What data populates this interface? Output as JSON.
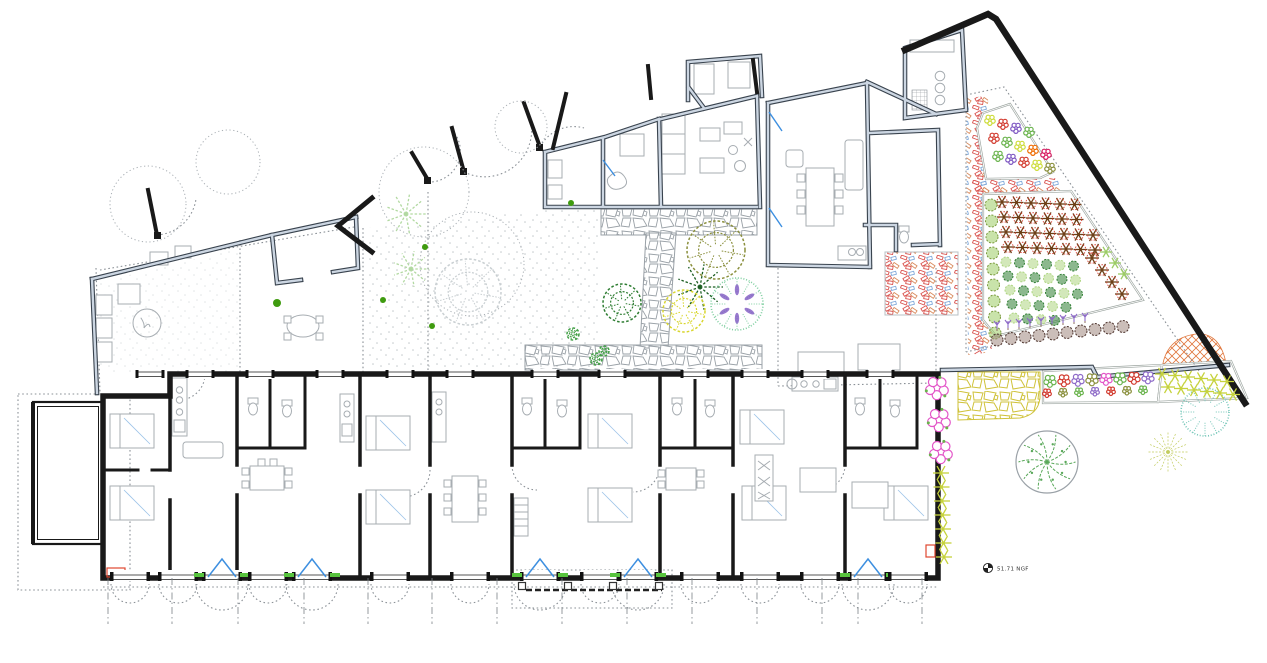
{
  "annotations": {
    "level_marker": "51.71 NGF"
  },
  "palette": {
    "new_wall": "#191919",
    "existing_wall_edge": "#39434e",
    "existing_wall_core": "#ccd6e2",
    "furniture_line": "#a7adb2",
    "stone_joint": "#9aa1a7",
    "yellow_stone": "#cfc23a",
    "rubble_red": "#d9534f",
    "rubble_blue": "#7fa8d9",
    "orange_hatch": "#e0763c",
    "door_blue": "#3d8fe0",
    "threshold_green": "#58c43e",
    "boundary_dot": "#8a9096",
    "pink_flower": "#e356c8",
    "purple_flower": "#8e6bc8",
    "olive_tree": "#8a8f3c",
    "yellow_tree": "#d9d62f",
    "teal_tree": "#74c6b8",
    "dark_green": "#2e7d32",
    "light_green": "#b2d9a1"
  },
  "facade": {
    "bottom_bays": [
      {
        "x": 130,
        "type": "window"
      },
      {
        "x": 178,
        "type": "window"
      },
      {
        "x": 222,
        "type": "door"
      },
      {
        "x": 268,
        "type": "window"
      },
      {
        "x": 312,
        "type": "door"
      },
      {
        "x": 390,
        "type": "window"
      },
      {
        "x": 470,
        "type": "window"
      },
      {
        "x": 540,
        "type": "door"
      },
      {
        "x": 600,
        "type": "window"
      },
      {
        "x": 638,
        "type": "door"
      },
      {
        "x": 700,
        "type": "window"
      },
      {
        "x": 760,
        "type": "window"
      },
      {
        "x": 820,
        "type": "window"
      },
      {
        "x": 868,
        "type": "door"
      },
      {
        "x": 908,
        "type": "window"
      }
    ],
    "top_windows": [
      150,
      200,
      260,
      330,
      400,
      460,
      545,
      612,
      695,
      755,
      815,
      880
    ]
  },
  "grid_axes": [
    108,
    172,
    238,
    304,
    368,
    432,
    497,
    562,
    627,
    692,
    757,
    822,
    858,
    922
  ],
  "pergola": {
    "posts": [
      522,
      568,
      613,
      659
    ],
    "rail": [
      526,
      662
    ],
    "y": 586
  },
  "plants": [
    {
      "name": "tree-canopy",
      "type": "canopy",
      "x": 148,
      "y": 204,
      "r": 38,
      "color": "#a9afb4"
    },
    {
      "name": "tree-canopy",
      "type": "canopy",
      "x": 228,
      "y": 162,
      "r": 32,
      "color": "#a9afb4"
    },
    {
      "name": "tree-canopy",
      "type": "canopy",
      "x": 424,
      "y": 192,
      "r": 45,
      "color": "#a9afb4"
    },
    {
      "name": "tree-canopy",
      "type": "canopy",
      "x": 472,
      "y": 264,
      "r": 52,
      "color": "#a9afb4"
    },
    {
      "name": "tree-canopy",
      "type": "canopy",
      "x": 521,
      "y": 127,
      "r": 26,
      "color": "#a9afb4"
    },
    {
      "name": "palm-tree",
      "type": "palm",
      "x": 406,
      "y": 214,
      "r": 20,
      "color": "#b2d9a1"
    },
    {
      "name": "palm-tree",
      "type": "palm",
      "x": 411,
      "y": 269,
      "r": 18,
      "color": "#b2d9a1"
    },
    {
      "name": "outline-tree",
      "type": "scribble",
      "x": 468,
      "y": 292,
      "r": 33,
      "color": "#c9cfd2"
    },
    {
      "name": "courtyard-tree",
      "type": "scribble",
      "x": 622,
      "y": 303,
      "r": 19,
      "color": "#2e7d32"
    },
    {
      "name": "courtyard-palm",
      "type": "palm",
      "x": 700,
      "y": 287,
      "r": 23,
      "color": "#1b5e20"
    },
    {
      "name": "courtyard-tree",
      "type": "scribble",
      "x": 716,
      "y": 250,
      "r": 29,
      "color": "#8a8f3c"
    },
    {
      "name": "courtyard-tree",
      "type": "scribble",
      "x": 684,
      "y": 311,
      "r": 21,
      "color": "#d9d62f"
    },
    {
      "name": "courtyard-tree",
      "type": "fringe",
      "x": 737,
      "y": 304,
      "r": 26,
      "color": "#7fcfa0",
      "accent": "#7e57c2"
    },
    {
      "name": "shrub",
      "type": "scribble",
      "x": 573,
      "y": 334,
      "r": 6,
      "color": "#43a047"
    },
    {
      "name": "shrub",
      "type": "scribble",
      "x": 596,
      "y": 359,
      "r": 6,
      "color": "#43a047"
    },
    {
      "name": "shrub",
      "type": "scribble",
      "x": 604,
      "y": 351,
      "r": 5,
      "color": "#43a047"
    },
    {
      "name": "small-plant",
      "type": "dot",
      "x": 277,
      "y": 303,
      "r": 4,
      "color": "#3f9b0f"
    },
    {
      "name": "small-plant",
      "type": "dot",
      "x": 383,
      "y": 300,
      "r": 3,
      "color": "#3f9b0f"
    },
    {
      "name": "small-plant",
      "type": "dot",
      "x": 432,
      "y": 326,
      "r": 3,
      "color": "#3f9b0f"
    },
    {
      "name": "small-plant",
      "type": "dot",
      "x": 425,
      "y": 247,
      "r": 3,
      "color": "#3f9b0f"
    },
    {
      "name": "small-plant",
      "type": "dot",
      "x": 571,
      "y": 203,
      "r": 3,
      "color": "#3f9b0f"
    },
    {
      "name": "round-tree",
      "type": "branch",
      "x": 1047,
      "y": 462,
      "r": 31,
      "color": "#5aa85a"
    },
    {
      "name": "radial-tree",
      "type": "radial",
      "x": 1168,
      "y": 452,
      "r": 20,
      "color": "#c2cc5e"
    },
    {
      "name": "teal-tree",
      "type": "fringe",
      "x": 1205,
      "y": 412,
      "r": 24,
      "color": "#74c6b8"
    },
    {
      "name": "pink-shrub",
      "type": "cluster",
      "x": 937,
      "y": 388,
      "r": 13,
      "color": "#e356c8",
      "accent": "#69b34c"
    },
    {
      "name": "pink-shrub",
      "type": "cluster",
      "x": 939,
      "y": 420,
      "r": 13,
      "color": "#e356c8",
      "accent": "#69b34c"
    },
    {
      "name": "pink-shrub",
      "type": "cluster",
      "x": 941,
      "y": 452,
      "r": 13,
      "color": "#e356c8",
      "accent": "#69b34c"
    }
  ],
  "plant_rows": [
    {
      "name": "orchard-row",
      "type": "star",
      "color": "#6d3f17",
      "accent": "#d23b2f",
      "x0": 1002,
      "y0": 202,
      "dx": 14.5,
      "dy": 0.5,
      "n": 6,
      "r": 7
    },
    {
      "name": "orchard-row",
      "type": "star",
      "color": "#6d3f17",
      "accent": "#d23b2f",
      "x0": 1004,
      "y0": 217,
      "dx": 14.5,
      "dy": 0.5,
      "n": 6,
      "r": 7
    },
    {
      "name": "orchard-row",
      "type": "star",
      "color": "#6d3f17",
      "accent": "#d23b2f",
      "x0": 1006,
      "y0": 232,
      "dx": 14.5,
      "dy": 0.5,
      "n": 7,
      "r": 7
    },
    {
      "name": "orchard-row",
      "type": "star",
      "color": "#6d3f17",
      "accent": "#d23b2f",
      "x0": 1008,
      "y0": 247,
      "dx": 14.5,
      "dy": 0.5,
      "n": 7,
      "r": 7
    },
    {
      "name": "hedge-column",
      "type": "shrub",
      "color": "#9ccc65",
      "accent": "#7a9a3d",
      "x0": 991,
      "y0": 205,
      "dx": 0.5,
      "dy": 16,
      "n": 9,
      "r": 6
    },
    {
      "name": "crop-row",
      "colors": [
        "#aed581",
        "#2e7d32"
      ],
      "type": "shrub",
      "x0": 1006,
      "y0": 262,
      "dx": 13.5,
      "dy": 0.8,
      "n": 6,
      "r": 5
    },
    {
      "name": "crop-row",
      "colors": [
        "#2e7d32",
        "#aed581"
      ],
      "type": "shrub",
      "x0": 1008,
      "y0": 276,
      "dx": 13.5,
      "dy": 0.8,
      "n": 6,
      "r": 5
    },
    {
      "name": "crop-row",
      "colors": [
        "#aed581",
        "#2e7d32"
      ],
      "type": "shrub",
      "x0": 1010,
      "y0": 290,
      "dx": 13.5,
      "dy": 0.8,
      "n": 6,
      "r": 5
    },
    {
      "name": "crop-row",
      "colors": [
        "#2e7d32",
        "#aed581"
      ],
      "type": "shrub",
      "x0": 1012,
      "y0": 304,
      "dx": 13.5,
      "dy": 0.8,
      "n": 5,
      "r": 5
    },
    {
      "name": "crop-row",
      "colors": [
        "#aed581",
        "#2e7d32"
      ],
      "type": "shrub",
      "x0": 1014,
      "y0": 318,
      "dx": 13.5,
      "dy": 0.8,
      "n": 4,
      "r": 5
    },
    {
      "name": "orchard-diagonal",
      "type": "star",
      "color": "#6d3f17",
      "accent": "#d23b2f",
      "x0": 1092,
      "y0": 258,
      "dx": 10,
      "dy": 12,
      "n": 4,
      "r": 7
    },
    {
      "name": "orchard-diagonal",
      "type": "star",
      "color": "#9ccc65",
      "x0": 1106,
      "y0": 252,
      "dx": 9,
      "dy": 11,
      "n": 3,
      "r": 6
    },
    {
      "name": "lavender-row",
      "type": "sprig",
      "color": "#8e6bc8",
      "x0": 997,
      "y0": 326,
      "dx": 11,
      "dy": -1,
      "n": 9,
      "r": 5
    },
    {
      "name": "shrub-row",
      "type": "shrub",
      "color": "#a1887f",
      "accent": "#4e342e",
      "x0": 997,
      "y0": 340,
      "dx": 14,
      "dy": -1.5,
      "n": 10,
      "r": 6
    },
    {
      "name": "yellow-plant-column",
      "type": "star",
      "color": "#c6d23c",
      "x0": 941,
      "y0": 473,
      "dx": 0.5,
      "dy": 14,
      "n": 7,
      "r": 8
    },
    {
      "name": "yellow-plant-strip",
      "type": "star",
      "color": "#c6d23c",
      "x0": 1162,
      "y0": 374,
      "dx": 13,
      "dy": 1.5,
      "n": 6,
      "r": 7
    },
    {
      "name": "yellow-plant-strip",
      "type": "star",
      "color": "#c6d23c",
      "x0": 1168,
      "y0": 387,
      "dx": 13,
      "dy": 1.5,
      "n": 6,
      "r": 7
    },
    {
      "name": "flower-strip",
      "colors": [
        "#69b34c",
        "#d23b2f",
        "#8e6bc8",
        "#8a8f3c",
        "#e356c8"
      ],
      "type": "cluster",
      "x0": 1050,
      "y0": 381,
      "dx": 14,
      "dy": -0.5,
      "n": 8,
      "r": 7
    },
    {
      "name": "flower-strip",
      "colors": [
        "#d23b2f",
        "#8a8f3c",
        "#69b34c",
        "#8e6bc8"
      ],
      "type": "cluster",
      "x0": 1047,
      "y0": 393,
      "dx": 16,
      "dy": -0.5,
      "n": 7,
      "r": 5
    },
    {
      "name": "flower-bed-row",
      "colors": [
        "#cddc39",
        "#d23b2f",
        "#7e57c2",
        "#69b34c"
      ],
      "type": "cluster",
      "x0": 990,
      "y0": 120,
      "dx": 13,
      "dy": 4,
      "n": 4,
      "r": 6
    },
    {
      "name": "flower-bed-row",
      "colors": [
        "#d23b2f",
        "#69b34c",
        "#cddc39",
        "#ef6c00",
        "#d81b60"
      ],
      "type": "cluster",
      "x0": 994,
      "y0": 138,
      "dx": 13,
      "dy": 4,
      "n": 5,
      "r": 6
    },
    {
      "name": "flower-bed-row",
      "colors": [
        "#69b34c",
        "#7e57c2",
        "#d23b2f",
        "#cddc39",
        "#8a8f3c"
      ],
      "type": "cluster",
      "x0": 998,
      "y0": 156,
      "dx": 13,
      "dy": 3,
      "n": 5,
      "r": 6
    }
  ]
}
